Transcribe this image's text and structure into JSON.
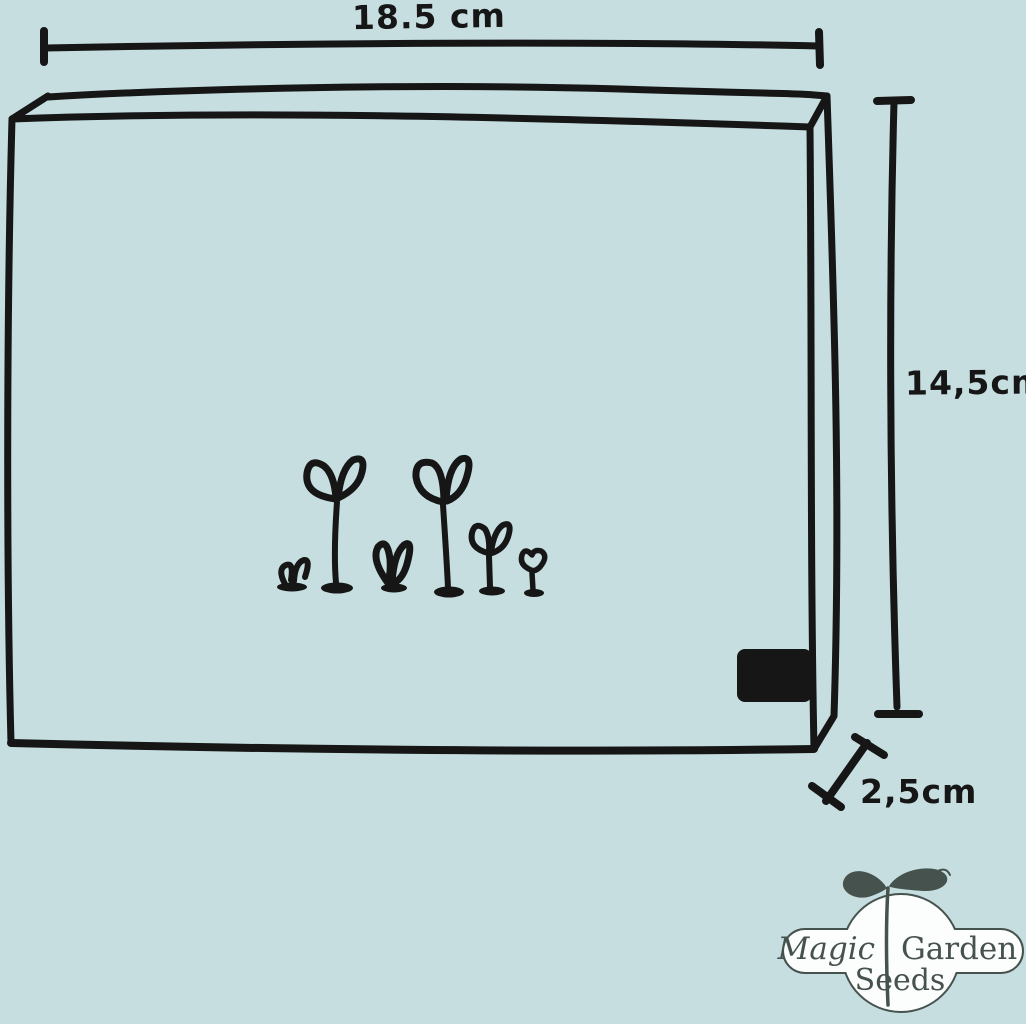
{
  "colors": {
    "background": "#c6dee0",
    "ink": "#161616",
    "logo_ink": "#46524d",
    "logo_bg": "#fcfdfd"
  },
  "dimensions": {
    "width_label": "18.5 cm",
    "height_label": "14,5cm",
    "depth_label": "2,5cm"
  },
  "logo": {
    "word_magic": "Magic",
    "word_garden": "Garden",
    "word_seeds": "Seeds"
  }
}
